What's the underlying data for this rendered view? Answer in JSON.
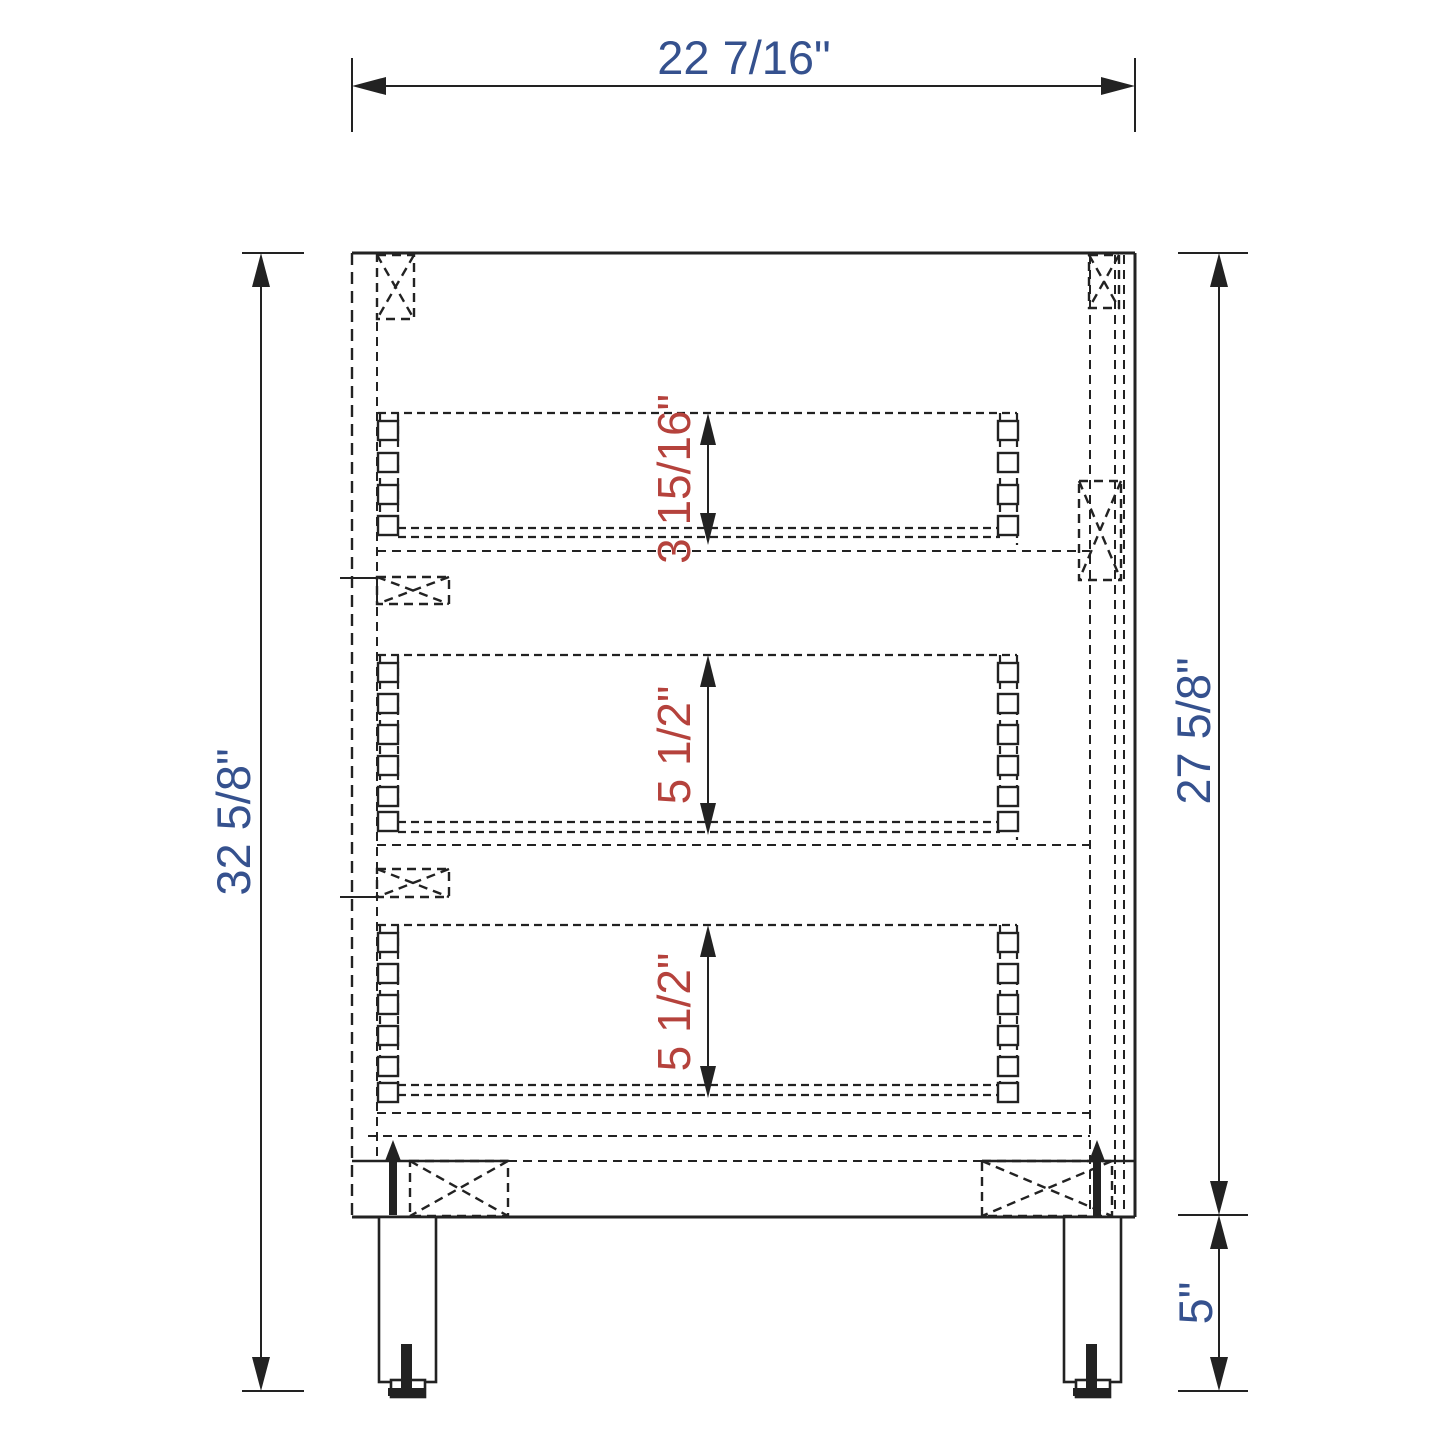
{
  "drawing": {
    "type": "cabinet-side-section",
    "colors": {
      "background": "#ffffff",
      "line": "#222222",
      "dimension_text_primary": "#35518e",
      "dimension_text_drawer": "#b5423c"
    },
    "dimensions": {
      "overall_width": {
        "location": "top",
        "label": "22 7/16\""
      },
      "overall_height": {
        "location": "left",
        "label": "32 5/8\""
      },
      "carcass_height": {
        "location": "right",
        "label": "27 5/8\""
      },
      "leg_height": {
        "location": "bottom-right",
        "label": "5\""
      },
      "drawer_heights": [
        {
          "drawer": "top",
          "label": "3 15/16\""
        },
        {
          "drawer": "middle",
          "label": "5 1/2\""
        },
        {
          "drawer": "bottom",
          "label": "5 1/2\""
        }
      ]
    }
  }
}
